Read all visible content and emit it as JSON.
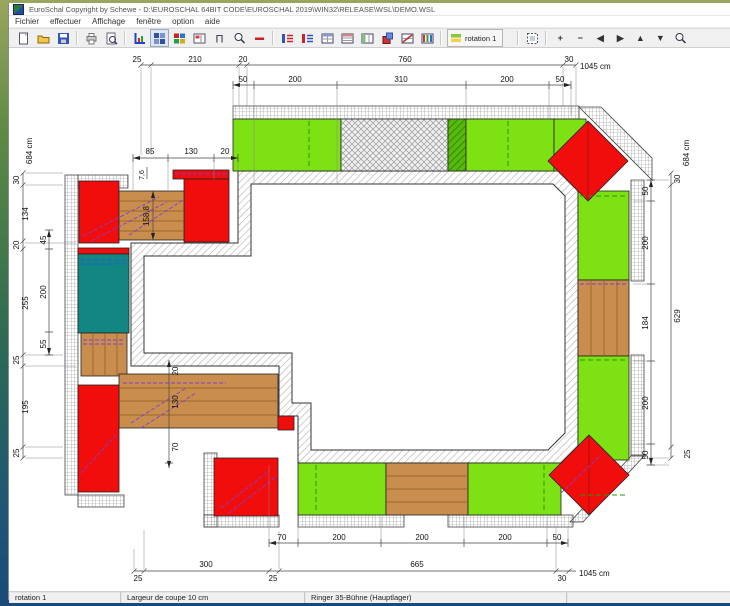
{
  "window": {
    "title": "EuroSchal Copyright by Schewe - D:\\EUROSCHAL 64BIT CODE\\EUROSCHAL 2019\\WIN32\\RELEASE\\WSL\\DEMO.WSL"
  },
  "menu": {
    "items": [
      "Fichier",
      "effectuer",
      "Affichage",
      "fenêtre",
      "option",
      "aide"
    ]
  },
  "toolbar": {
    "rotation_label": "rotation 1"
  },
  "statusbar": {
    "cells": [
      "rotation 1",
      "Largeur de coupe 10 cm",
      "Ringer 35-Bühne (Hauptlager)"
    ]
  },
  "drawing": {
    "dims": {
      "top_outer": [
        "25",
        "210",
        "20",
        "760",
        "30"
      ],
      "top_total": "1045 cm",
      "top_inner": [
        "50",
        "200",
        "310",
        "200",
        "50"
      ],
      "left_outer": [
        "684 cm",
        "30",
        "134",
        "20",
        "255",
        "25",
        "195",
        "25"
      ],
      "left_inner": [
        "45",
        "200",
        "55"
      ],
      "right_outer": [
        "30",
        "684 cm",
        "629",
        "25"
      ],
      "right_inner": [
        "50",
        "200",
        "184",
        "200",
        "50"
      ],
      "bottom_outer": [
        "25",
        "300",
        "25",
        "665",
        "30"
      ],
      "bottom_total": "1045 cm",
      "bottom_inner": [
        "70",
        "200",
        "200",
        "200",
        "50"
      ],
      "detail_top_left": [
        "85",
        "130",
        "20"
      ],
      "detail_vert_small": "7,6",
      "detail_vert_big": "158,8",
      "detail_bottom_left": [
        "20",
        "130",
        "70"
      ]
    },
    "colors": {
      "panel_green": "#7de114",
      "panel_red": "#f20d0d",
      "panel_brown": "#c98e4e",
      "panel_teal": "#128782",
      "wall_hatch": "#b5b5b5",
      "platform_grid": "#8a8a8a"
    }
  }
}
